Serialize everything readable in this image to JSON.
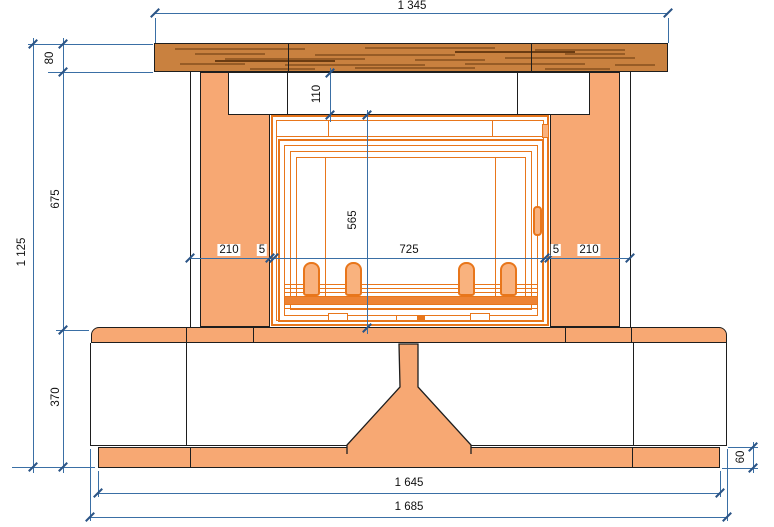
{
  "drawing": {
    "title": "Fireplace front elevation",
    "dimensions": {
      "mantel_width": "1 345",
      "mantel_thickness": "80",
      "frieze_height": "110",
      "firebox_opening_height": "565",
      "surround_height": "675",
      "total_height": "1 125",
      "left_leg_width": "210",
      "left_gap": "5",
      "firebox_opening_width": "725",
      "right_gap": "5",
      "right_leg_width": "210",
      "bench_height": "370",
      "plinth_height": "60",
      "plinth_width": "1 645",
      "bench_width": "1 685"
    },
    "colors": {
      "salmon_fill": "#F7A873",
      "firebox_orange": "#E8761B",
      "wood_fill": "#C9813F",
      "wood_grain": "#7A4718",
      "dimension_line": "#3A6FA5",
      "outline": "#1E1E1E",
      "background": "#FFFFFF"
    }
  }
}
